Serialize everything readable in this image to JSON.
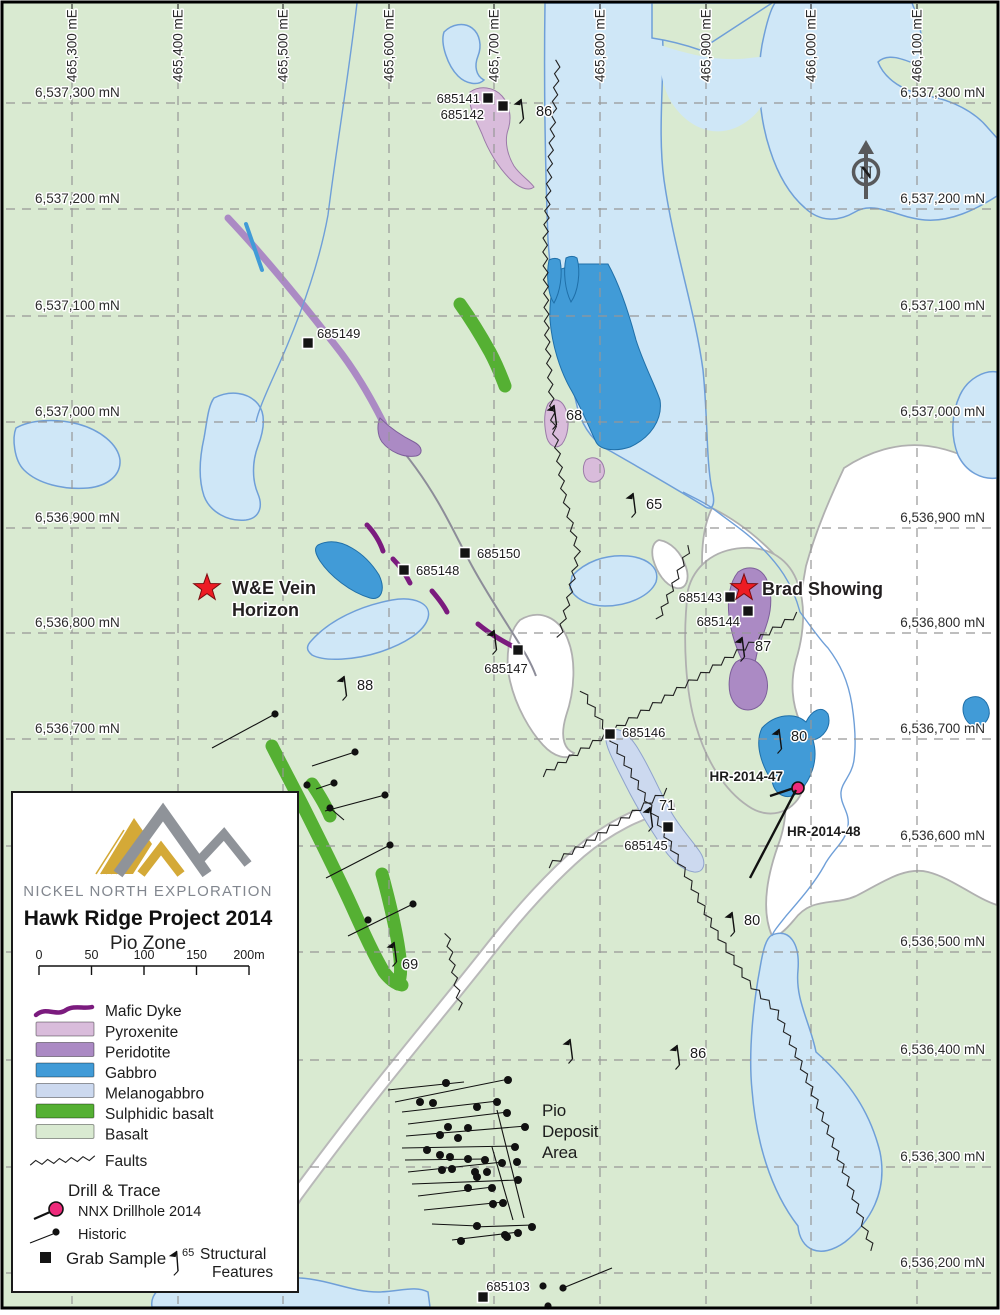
{
  "title_block": {
    "company": "NICKEL NORTH EXPLORATION",
    "title": "Hawk Ridge Project 2014",
    "subtitle": "Pio Zone",
    "scale_ticks": [
      "0",
      "50",
      "100",
      "150",
      "200m"
    ]
  },
  "legend": {
    "items": [
      {
        "label": "Mafic Dyke",
        "type": "line",
        "color": "#7b1b7e"
      },
      {
        "label": "Pyroxenite",
        "type": "swatch",
        "color": "#d9bcdb"
      },
      {
        "label": "Peridotite",
        "type": "swatch",
        "color": "#ab8ac4"
      },
      {
        "label": "Gabbro",
        "type": "swatch",
        "color": "#419bd7"
      },
      {
        "label": "Melanogabbro",
        "type": "swatch",
        "color": "#ccd9ef"
      },
      {
        "label": "Sulphidic basalt",
        "type": "swatch",
        "color": "#55b033"
      },
      {
        "label": "Basalt",
        "type": "swatch",
        "color": "#d9ead1"
      },
      {
        "label": "Faults",
        "type": "fault"
      }
    ],
    "drill_heading": "Drill & Trace",
    "nnx_label": "NNX Drillhole 2014",
    "nnx_color": "#ee2a7b",
    "historic_label": "Historic",
    "grab_label": "Grab Sample",
    "structural_value": "65",
    "structural_line1": "Structural",
    "structural_line2": "Features"
  },
  "grid": {
    "eastings": [
      {
        "label": "465,300 mE",
        "x": 72
      },
      {
        "label": "465,400 mE",
        "x": 178
      },
      {
        "label": "465,500 mE",
        "x": 283
      },
      {
        "label": "465,600 mE",
        "x": 389
      },
      {
        "label": "465,700 mE",
        "x": 494
      },
      {
        "label": "465,800 mE",
        "x": 600
      },
      {
        "label": "465,900 mE",
        "x": 706
      },
      {
        "label": "466,000 mE",
        "x": 811
      },
      {
        "label": "466,100 mE",
        "x": 917
      }
    ],
    "northings": [
      {
        "label": "6,537,300 mN",
        "y": 103,
        "left": true,
        "right": true
      },
      {
        "label": "6,537,200 mN",
        "y": 209,
        "left": true,
        "right": true
      },
      {
        "label": "6,537,100 mN",
        "y": 316,
        "left": true,
        "right": true
      },
      {
        "label": "6,537,000 mN",
        "y": 422,
        "left": true,
        "right": true
      },
      {
        "label": "6,536,900 mN",
        "y": 528,
        "left": true,
        "right": true
      },
      {
        "label": "6,536,800 mN",
        "y": 633,
        "left": true,
        "right": true
      },
      {
        "label": "6,536,700 mN",
        "y": 739,
        "left": true,
        "right": true
      },
      {
        "label": "6,536,600 mN",
        "y": 846,
        "left": false,
        "right": true
      },
      {
        "label": "6,536,500 mN",
        "y": 952,
        "left": false,
        "right": true
      },
      {
        "label": "6,536,400 mN",
        "y": 1060,
        "left": false,
        "right": true
      },
      {
        "label": "6,536,300 mN",
        "y": 1167,
        "left": false,
        "right": true
      },
      {
        "label": "6,536,200 mN",
        "y": 1273,
        "left": false,
        "right": true
      }
    ]
  },
  "annotations": {
    "we_vein_line1": "W&E Vein",
    "we_vein_line2": "Horizon",
    "brad": "Brad Showing",
    "pio_line1": "Pio",
    "pio_line2": "Deposit",
    "pio_line3": "Area",
    "north_letter": "N"
  },
  "grab_samples": [
    {
      "id": "685141",
      "x": 488,
      "y": 98,
      "lx": 480,
      "ly": 103,
      "anchor": "end"
    },
    {
      "id": "685142",
      "x": 503,
      "y": 106,
      "lx": 484,
      "ly": 119,
      "anchor": "end"
    },
    {
      "id": "685149",
      "x": 308,
      "y": 343,
      "lx": 317,
      "ly": 338,
      "anchor": "start"
    },
    {
      "id": "685150",
      "x": 465,
      "y": 553,
      "lx": 477,
      "ly": 558,
      "anchor": "start"
    },
    {
      "id": "685148",
      "x": 404,
      "y": 570,
      "lx": 416,
      "ly": 575,
      "anchor": "start"
    },
    {
      "id": "685147",
      "x": 518,
      "y": 650,
      "lx": 506,
      "ly": 673,
      "anchor": "middle"
    },
    {
      "id": "685143",
      "x": 730,
      "y": 597,
      "lx": 722,
      "ly": 602,
      "anchor": "end"
    },
    {
      "id": "685144",
      "x": 748,
      "y": 611,
      "lx": 740,
      "ly": 626,
      "anchor": "end"
    },
    {
      "id": "685146",
      "x": 610,
      "y": 734,
      "lx": 622,
      "ly": 737,
      "anchor": "start"
    },
    {
      "id": "685145",
      "x": 668,
      "y": 827,
      "lx": 646,
      "ly": 850,
      "anchor": "middle"
    },
    {
      "id": "685103",
      "x": 483,
      "y": 1297,
      "lx": 508,
      "ly": 1291,
      "anchor": "middle"
    }
  ],
  "structural_measurements": [
    {
      "value": "86",
      "sx": 521,
      "sy": 110,
      "tx": 536,
      "ty": 116
    },
    {
      "value": "68",
      "sx": 554,
      "sy": 416,
      "tx": 566,
      "ty": 420
    },
    {
      "value": "65",
      "sx": 633,
      "sy": 504,
      "tx": 646,
      "ty": 509
    },
    {
      "value": "88",
      "sx": 344,
      "sy": 687,
      "tx": 357,
      "ty": 690
    },
    {
      "value": "87",
      "sx": 742,
      "sy": 648,
      "tx": 755,
      "ty": 651
    },
    {
      "value": "80",
      "sx": 779,
      "sy": 740,
      "tx": 791,
      "ty": 741
    },
    {
      "value": "71",
      "sx": 650,
      "sy": 818,
      "tx": 659,
      "ty": 810
    },
    {
      "value": "69",
      "sx": 394,
      "sy": 953,
      "tx": 402,
      "ty": 969
    },
    {
      "value": "80",
      "sx": 732,
      "sy": 923,
      "tx": 744,
      "ty": 925
    },
    {
      "value": "86",
      "sx": 677,
      "sy": 1056,
      "tx": 690,
      "ty": 1058
    },
    {
      "value": "",
      "sx": 570,
      "sy": 1050,
      "tx": 0,
      "ty": 0
    },
    {
      "value": "",
      "sx": 494,
      "sy": 641,
      "tx": 0,
      "ty": 0
    }
  ],
  "nnx_drillholes": [
    {
      "id": "HR-2014-47",
      "collar": [
        798,
        788
      ],
      "trace": [
        [
          797,
          787
        ],
        [
          770,
          796
        ]
      ],
      "lx": 783,
      "ly": 781,
      "anchor": "end"
    },
    {
      "id": "HR-2014-48",
      "collar": null,
      "trace": [
        [
          796,
          790
        ],
        [
          750,
          878
        ]
      ],
      "lx": 787,
      "ly": 836,
      "anchor": "start"
    }
  ],
  "historic_drillholes": {
    "cluster_dots": [
      [
        446,
        1083
      ],
      [
        508,
        1080
      ],
      [
        420,
        1102
      ],
      [
        433,
        1103
      ],
      [
        497,
        1102
      ],
      [
        477,
        1107
      ],
      [
        507,
        1113
      ],
      [
        448,
        1127
      ],
      [
        468,
        1128
      ],
      [
        525,
        1127
      ],
      [
        440,
        1135
      ],
      [
        458,
        1138
      ],
      [
        427,
        1150
      ],
      [
        440,
        1155
      ],
      [
        450,
        1157
      ],
      [
        515,
        1147
      ],
      [
        468,
        1159
      ],
      [
        485,
        1160
      ],
      [
        502,
        1163
      ],
      [
        517,
        1162
      ],
      [
        442,
        1170
      ],
      [
        452,
        1169
      ],
      [
        475,
        1172
      ],
      [
        487,
        1172
      ],
      [
        477,
        1177
      ],
      [
        468,
        1188
      ],
      [
        492,
        1188
      ],
      [
        518,
        1180
      ],
      [
        493,
        1204
      ],
      [
        503,
        1203
      ],
      [
        477,
        1226
      ],
      [
        532,
        1227
      ],
      [
        507,
        1237
      ],
      [
        518,
        1233
      ],
      [
        461,
        1241
      ],
      [
        505,
        1235
      ]
    ],
    "cluster_lines": [
      [
        388,
        1090,
        464,
        1082
      ],
      [
        395,
        1102,
        509,
        1079
      ],
      [
        402,
        1112,
        498,
        1101
      ],
      [
        408,
        1124,
        508,
        1112
      ],
      [
        406,
        1136,
        526,
        1126
      ],
      [
        402,
        1148,
        516,
        1146
      ],
      [
        405,
        1160,
        486,
        1159
      ],
      [
        408,
        1172,
        503,
        1162
      ],
      [
        412,
        1184,
        518,
        1180
      ],
      [
        418,
        1196,
        493,
        1187
      ],
      [
        424,
        1210,
        504,
        1202
      ],
      [
        432,
        1224,
        478,
        1226
      ],
      [
        452,
        1240,
        519,
        1232
      ],
      [
        497,
        1110,
        524,
        1218
      ],
      [
        492,
        1147,
        513,
        1220
      ],
      [
        473,
        1227,
        533,
        1225
      ]
    ],
    "outliers": [
      {
        "dot": [
          275,
          714
        ],
        "line": [
          212,
          748
        ]
      },
      {
        "dot": [
          355,
          752
        ],
        "line": [
          312,
          766
        ]
      },
      {
        "dot": [
          334,
          783
        ],
        "line": [
          316,
          789
        ]
      },
      {
        "dot": [
          307,
          785
        ],
        "line": null
      },
      {
        "dot": [
          385,
          795
        ],
        "line": [
          325,
          811
        ]
      },
      {
        "dot": [
          330,
          808
        ],
        "line": [
          344,
          820
        ]
      },
      {
        "dot": [
          390,
          845
        ],
        "line": [
          326,
          878
        ]
      },
      {
        "dot": [
          413,
          904
        ],
        "line": [
          348,
          936
        ]
      },
      {
        "dot": [
          368,
          920
        ],
        "line": null
      },
      {
        "dot": [
          543,
          1286
        ],
        "line": null
      },
      {
        "dot": [
          563,
          1288
        ],
        "line": [
          612,
          1268
        ]
      },
      {
        "dot": [
          548,
          1306
        ],
        "line": null
      }
    ]
  },
  "markers": {
    "we_vein_star": [
      207,
      588
    ],
    "brad_star": [
      744,
      588
    ],
    "star_color": "#ed1c24"
  }
}
